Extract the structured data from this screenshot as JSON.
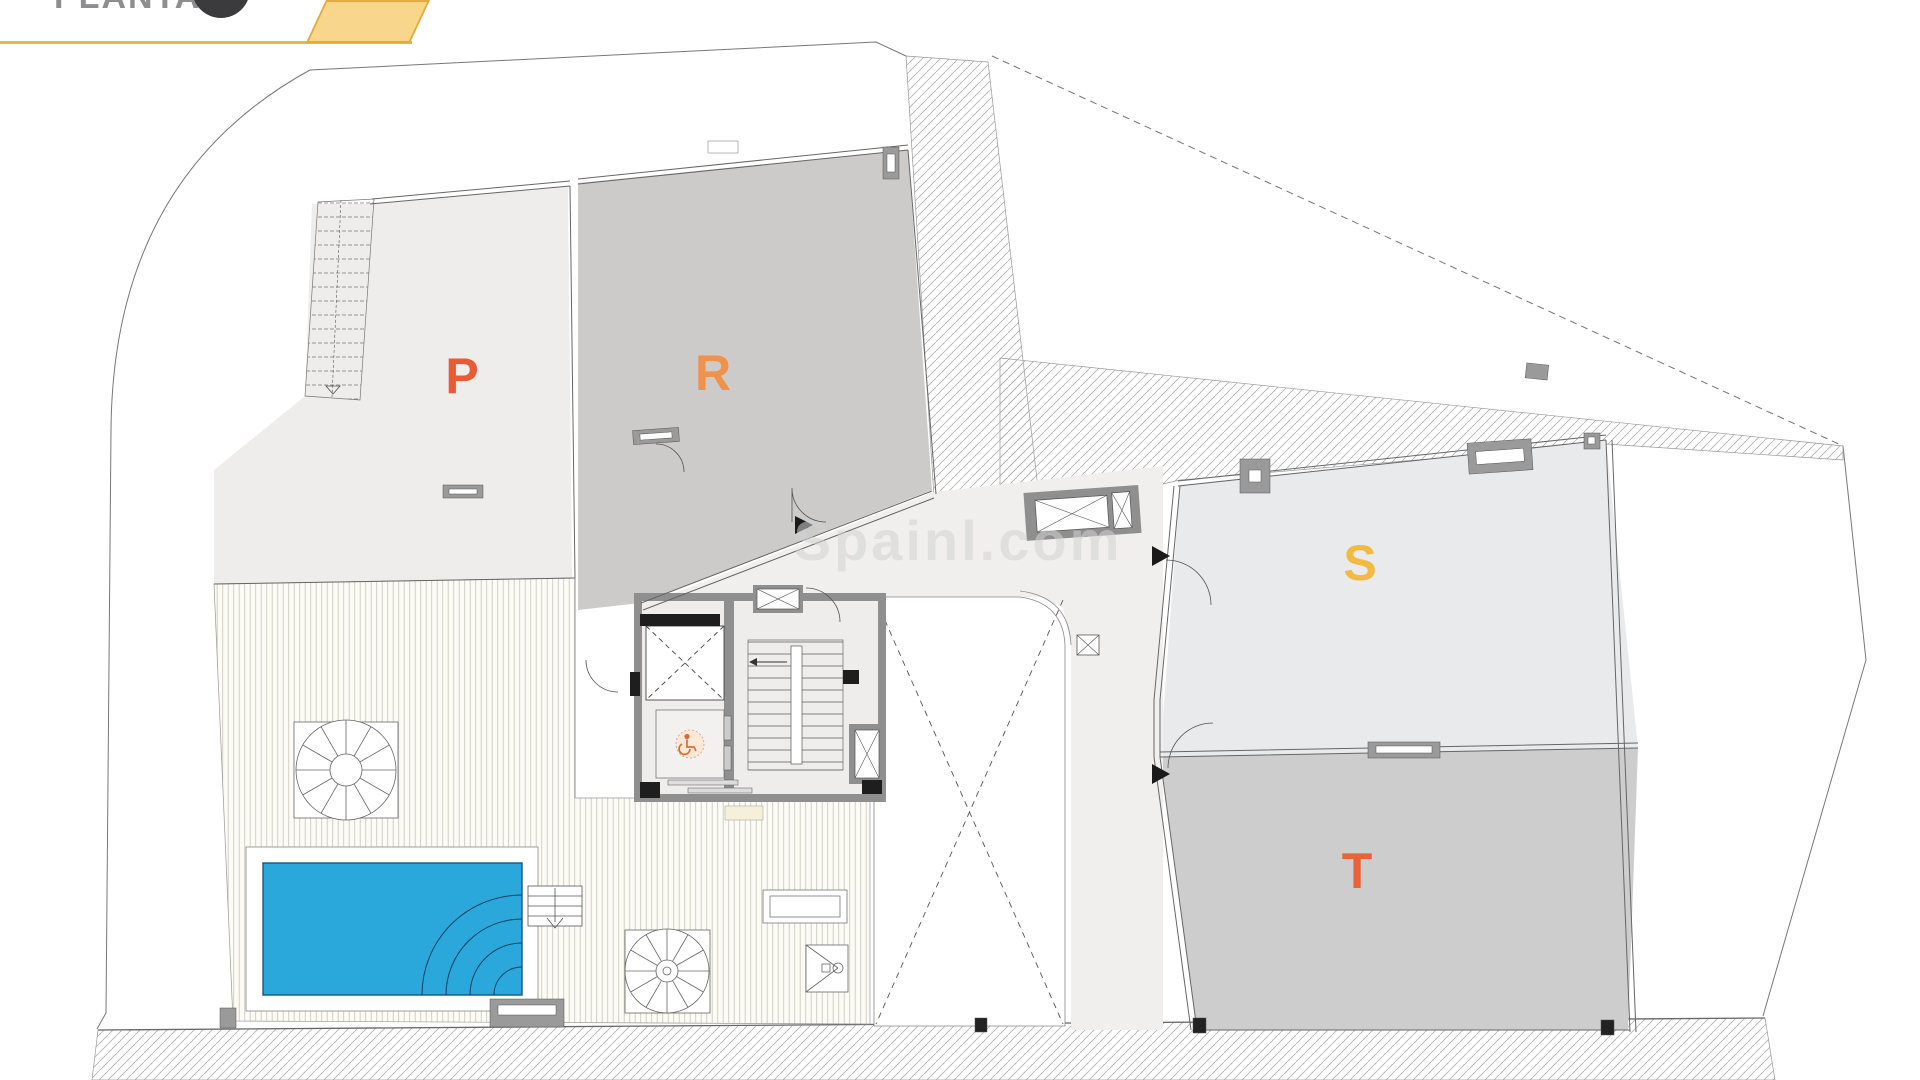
{
  "header": {
    "title": "PLANTA",
    "title_color": "#8E8E90",
    "accent_color": "#E8B44C",
    "flag_fill": "#F8D78C",
    "badge_color": "#3B3B3D"
  },
  "watermark": {
    "text": "Spainl.com",
    "color": "#D2D2D2"
  },
  "plan": {
    "units": [
      {
        "label": "P",
        "color": "#E85C35"
      },
      {
        "label": "R",
        "color": "#F0914C"
      },
      {
        "label": "S",
        "color": "#F2BA43"
      },
      {
        "label": "T",
        "color": "#EB6239"
      }
    ],
    "colors": {
      "unit_p_fill": "#EFEDEB",
      "unit_r_fill": "#CCCBCA",
      "unit_s_fill": "#E8EAEC",
      "unit_t_fill": "#CDCDCD",
      "corridor_fill": "#F1EFEE",
      "wall": "#8F8F8F",
      "pool": "#2AA7DB",
      "pool_edge": "#16577E",
      "deck_stripe": "#CFCCBE",
      "hatch_line": "#B0B0B0"
    },
    "icons": {
      "wheelchair": "♿",
      "entry_arrow": "black right-pointing triangle",
      "spiral_stair": "circle with radial spokes",
      "elevator": "rectangle with X cross"
    }
  }
}
